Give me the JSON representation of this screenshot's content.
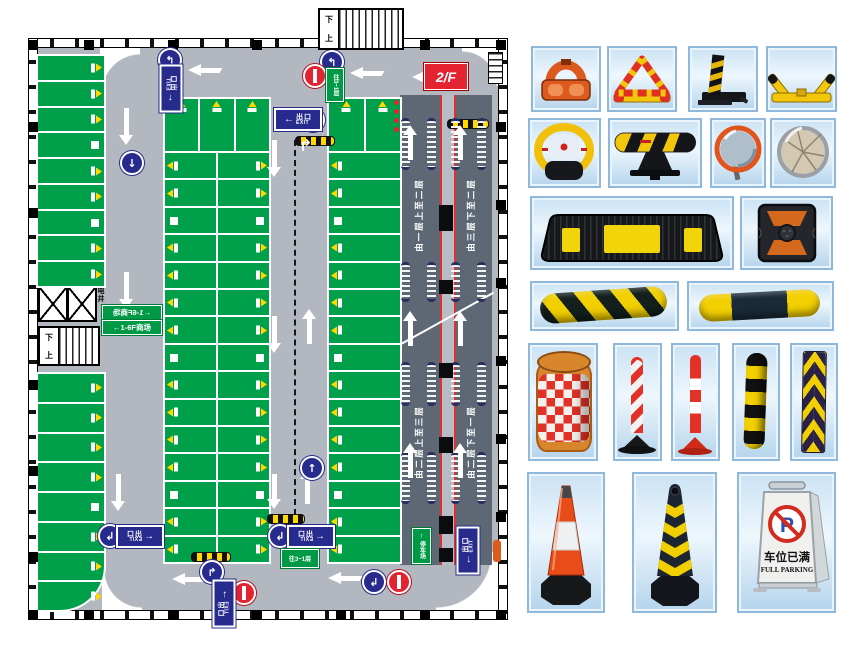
{
  "floorplan": {
    "floor_label": "2/F",
    "exit_sign": {
      "arrow": "←",
      "cn": "出口",
      "en": "EXIT"
    },
    "stairs": {
      "down": "下",
      "up": "上"
    },
    "shaft_label": "电井",
    "mall_sign": "←1-6F商场",
    "info_sign": "往3~1层",
    "parking_sign": "停车场",
    "ramp_labels": [
      "由一层上至二层",
      "由三层下至二层",
      "由二层上至三层",
      "由二层下至一层"
    ],
    "icons": {
      "left_arrow": "←",
      "turn_left_up": "↰",
      "turn_right_up": "↱",
      "turn_left_down": "↲",
      "down_arrow": "↓",
      "up_arrow": "↑"
    },
    "colors": {
      "parking_green": "#00a04b",
      "road_gray": "#b3b7bf",
      "ramp_gray": "#5d6874",
      "sign_blue": "#272b8d",
      "alert_red": "#e32330",
      "marker_yellow": "#ffd800"
    }
  },
  "catalog": {
    "full_parking_sign": {
      "symbol": "P",
      "cn": "车位已满",
      "en": "FULL PARKING"
    },
    "items": [
      {
        "icon": "o-type-parking-lock"
      },
      {
        "icon": "a-type-triangle-parking-lock"
      },
      {
        "icon": "bollard-parking-lock"
      },
      {
        "icon": "k-type-parking-lock"
      },
      {
        "icon": "remote-ring-parking-lock"
      },
      {
        "icon": "bar-parking-lock"
      },
      {
        "icon": "convex-mirror-orange"
      },
      {
        "icon": "convex-mirror-round"
      },
      {
        "icon": "rubber-wheel-stop"
      },
      {
        "icon": "road-stud-reflector"
      },
      {
        "icon": "speed-hump-diagonal"
      },
      {
        "icon": "speed-hump-segmented"
      },
      {
        "icon": "crash-barrel"
      },
      {
        "icon": "warning-bollard-chevron"
      },
      {
        "icon": "warning-bollard-banded"
      },
      {
        "icon": "corner-guard-striped"
      },
      {
        "icon": "corner-guard-chevron"
      },
      {
        "icon": "traffic-cone-red"
      },
      {
        "icon": "traffic-cone-striped"
      },
      {
        "icon": "full-parking-stand-sign"
      }
    ]
  }
}
